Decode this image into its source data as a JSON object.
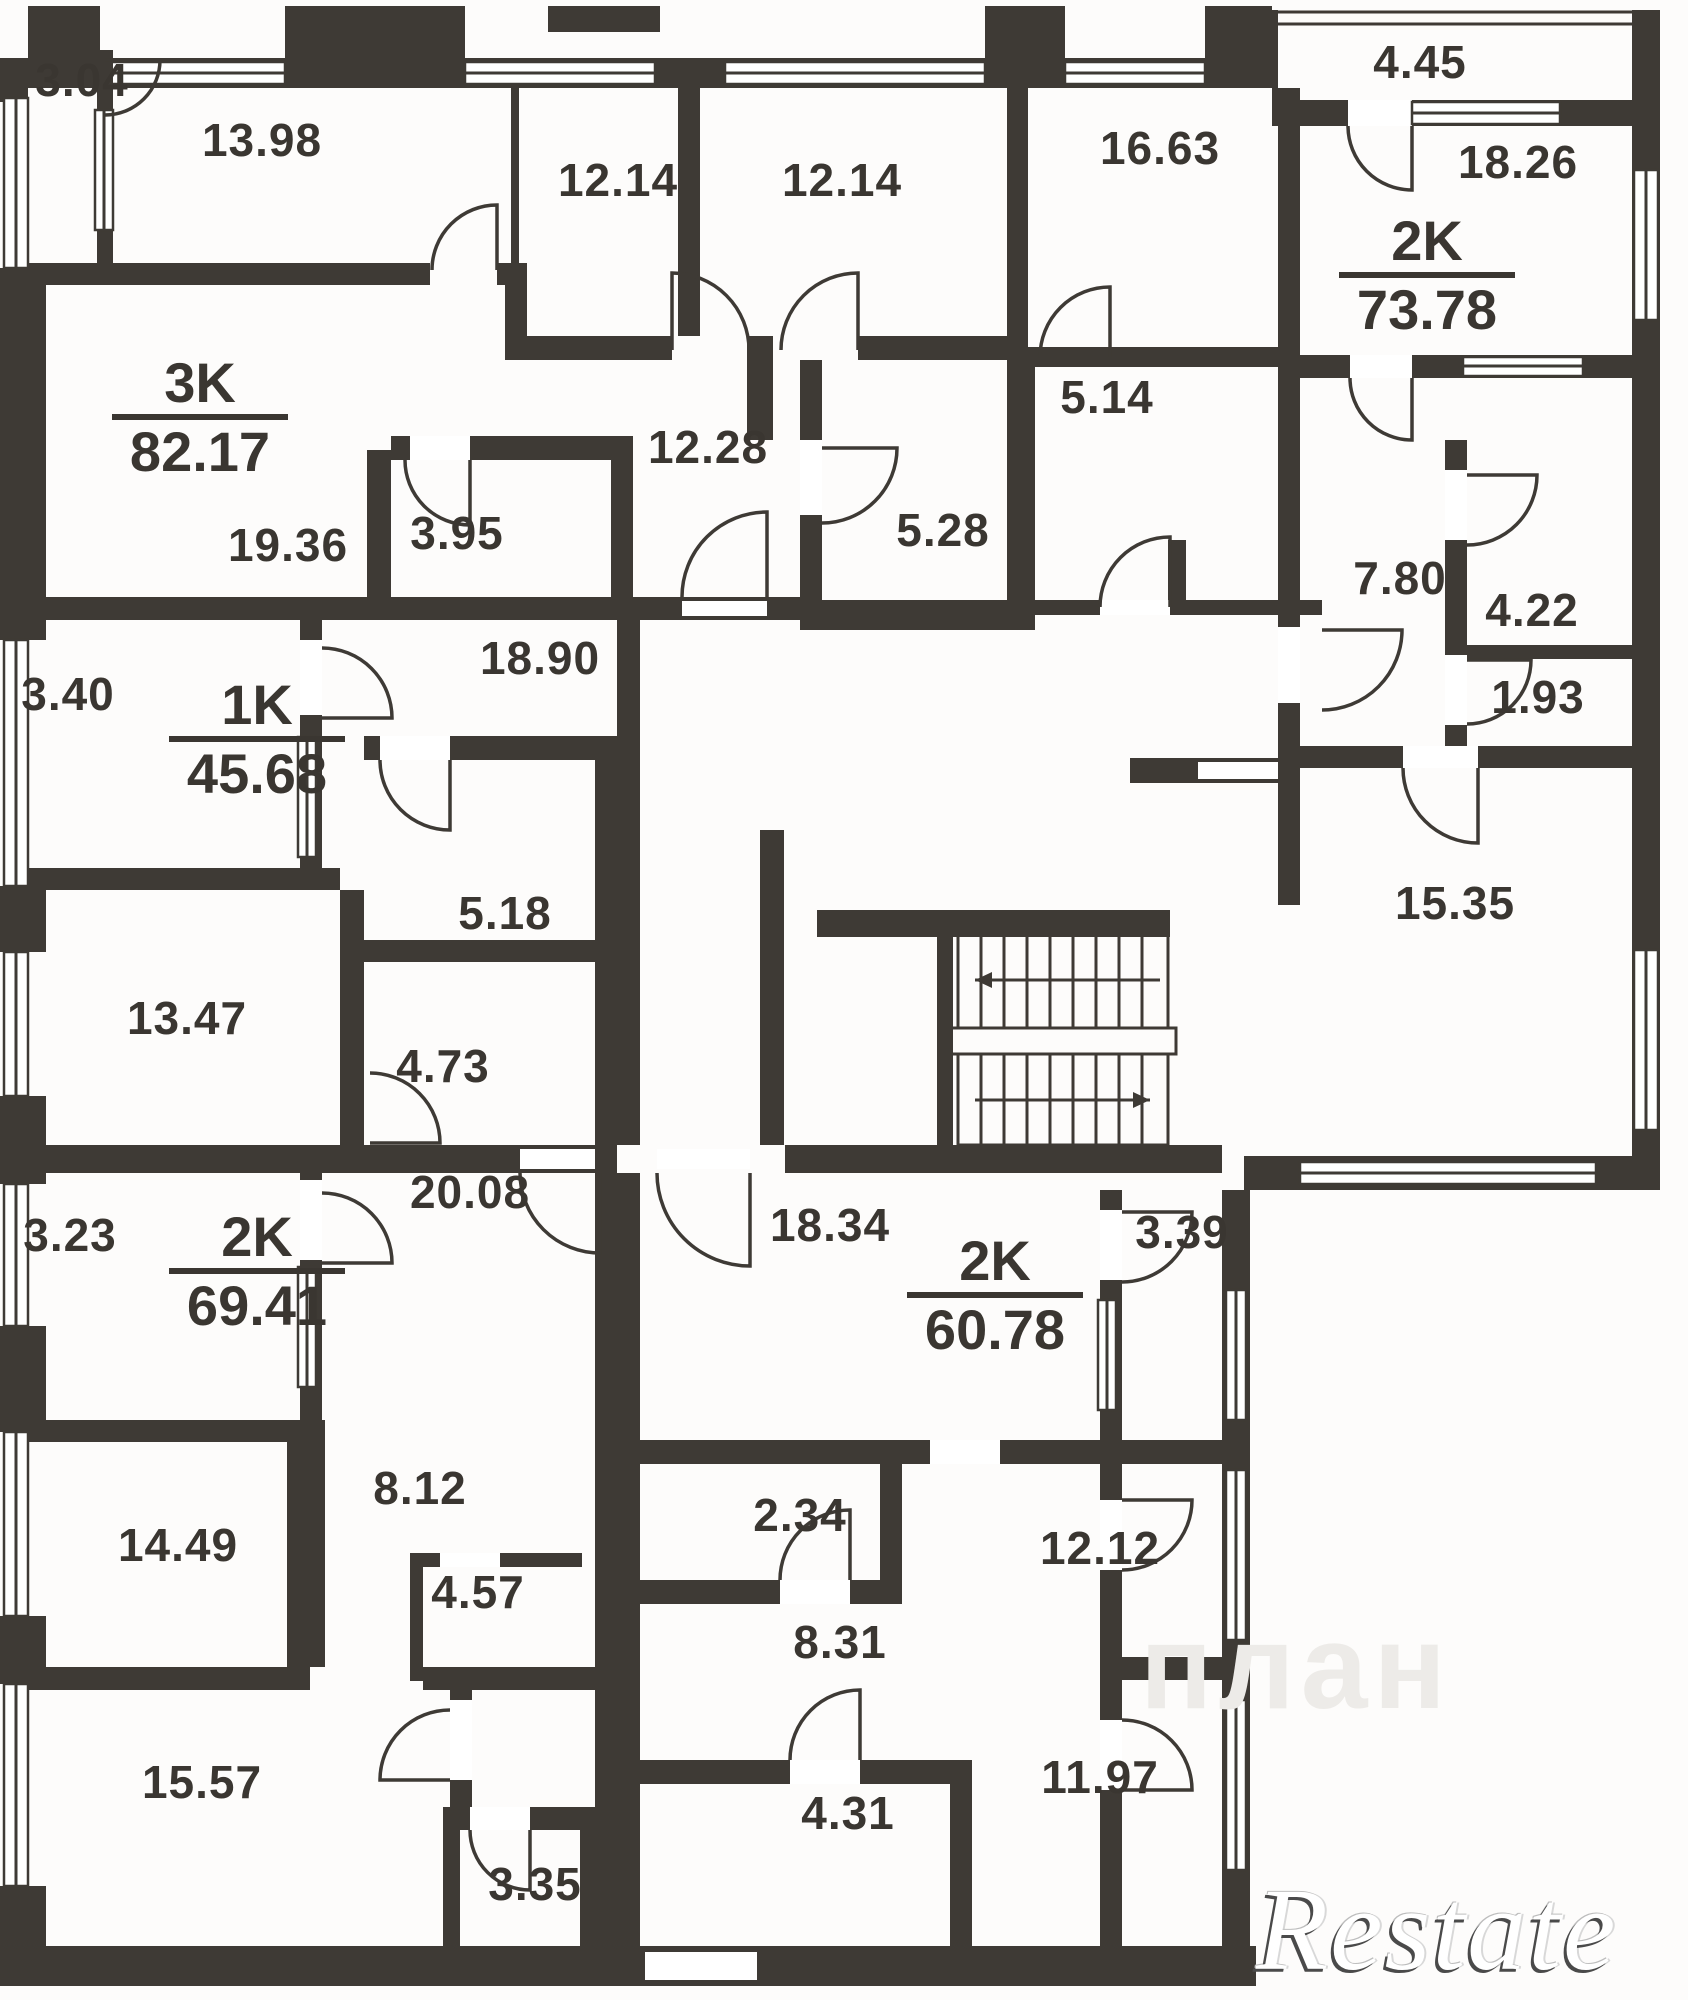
{
  "apartments": [
    {
      "type": "3K",
      "area": "82.17",
      "x": 200,
      "y": 418
    },
    {
      "type": "1K",
      "area": "45.68",
      "x": 257,
      "y": 740
    },
    {
      "type": "2K",
      "area": "73.78",
      "x": 1427,
      "y": 276
    },
    {
      "type": "2K",
      "area": "69.41",
      "x": 257,
      "y": 1272
    },
    {
      "type": "2K",
      "area": "60.78",
      "x": 995,
      "y": 1296
    }
  ],
  "rooms": [
    {
      "label": "3.04",
      "x": 82,
      "y": 80
    },
    {
      "label": "13.98",
      "x": 262,
      "y": 140
    },
    {
      "label": "12.14",
      "x": 618,
      "y": 180
    },
    {
      "label": "12.14",
      "x": 842,
      "y": 180
    },
    {
      "label": "16.63",
      "x": 1160,
      "y": 148
    },
    {
      "label": "4.45",
      "x": 1420,
      "y": 62
    },
    {
      "label": "18.26",
      "x": 1518,
      "y": 162
    },
    {
      "label": "5.14",
      "x": 1107,
      "y": 397
    },
    {
      "label": "12.28",
      "x": 708,
      "y": 447
    },
    {
      "label": "5.28",
      "x": 943,
      "y": 530
    },
    {
      "label": "3.95",
      "x": 457,
      "y": 533
    },
    {
      "label": "19.36",
      "x": 288,
      "y": 545
    },
    {
      "label": "7.80",
      "x": 1400,
      "y": 578
    },
    {
      "label": "4.22",
      "x": 1532,
      "y": 610
    },
    {
      "label": "18.90",
      "x": 540,
      "y": 658
    },
    {
      "label": "3.40",
      "x": 68,
      "y": 694
    },
    {
      "label": "1.93",
      "x": 1538,
      "y": 697
    },
    {
      "label": "15.35",
      "x": 1455,
      "y": 903
    },
    {
      "label": "5.18",
      "x": 505,
      "y": 913
    },
    {
      "label": "13.47",
      "x": 187,
      "y": 1018
    },
    {
      "label": "4.73",
      "x": 443,
      "y": 1066
    },
    {
      "label": "20.08",
      "x": 470,
      "y": 1192
    },
    {
      "label": "18.34",
      "x": 830,
      "y": 1225
    },
    {
      "label": "3.23",
      "x": 70,
      "y": 1235
    },
    {
      "label": "3.39",
      "x": 1182,
      "y": 1232
    },
    {
      "label": "8.12",
      "x": 420,
      "y": 1488
    },
    {
      "label": "2.34",
      "x": 800,
      "y": 1515
    },
    {
      "label": "14.49",
      "x": 178,
      "y": 1545
    },
    {
      "label": "12.12",
      "x": 1100,
      "y": 1548
    },
    {
      "label": "4.57",
      "x": 478,
      "y": 1592
    },
    {
      "label": "8.31",
      "x": 840,
      "y": 1642
    },
    {
      "label": "11.97",
      "x": 1100,
      "y": 1777
    },
    {
      "label": "15.57",
      "x": 202,
      "y": 1782
    },
    {
      "label": "4.31",
      "x": 848,
      "y": 1813
    },
    {
      "label": "3.35",
      "x": 535,
      "y": 1884
    }
  ],
  "watermark": {
    "brand": "Restate",
    "faint": "план"
  },
  "colors": {
    "wall": "#3e3a35",
    "background": "#fdfcfb",
    "label": "#3a3631"
  }
}
